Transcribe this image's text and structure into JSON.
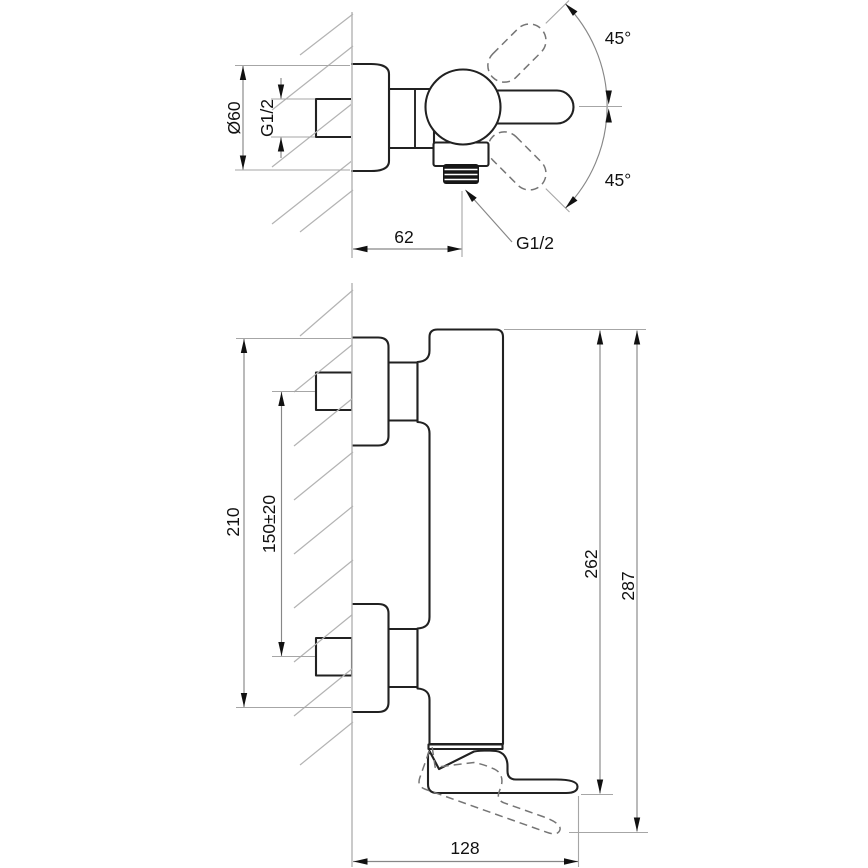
{
  "drawing": {
    "type": "technical-dimension-drawing",
    "subject": "wall-mounted single-lever shower mixer, two orthographic views",
    "views": {
      "top_view": "mixer seen from above with lever swing range",
      "side_view": "mixer seen from the side with lever positions"
    }
  },
  "labels": {
    "flange_diameter": "Ø60",
    "inlet_thread": "G1/2",
    "outlet_thread": "G1/2",
    "swing_angle_top": "45°",
    "swing_angle_bottom": "45°",
    "wall_to_outlet": "62",
    "overall_plate_span": "210",
    "inlet_centers_spacing": "150±20",
    "depth_to_handle": "262",
    "overall_depth": "287",
    "handle_projection": "128"
  },
  "colors": {
    "background": "#ffffff",
    "part_outline": "#212121",
    "dimension_line": "#878787",
    "extension_line": "#a6a6a6",
    "construction_line": "#b3b3b3",
    "dashed_position": "#757575",
    "text": "#111111"
  }
}
